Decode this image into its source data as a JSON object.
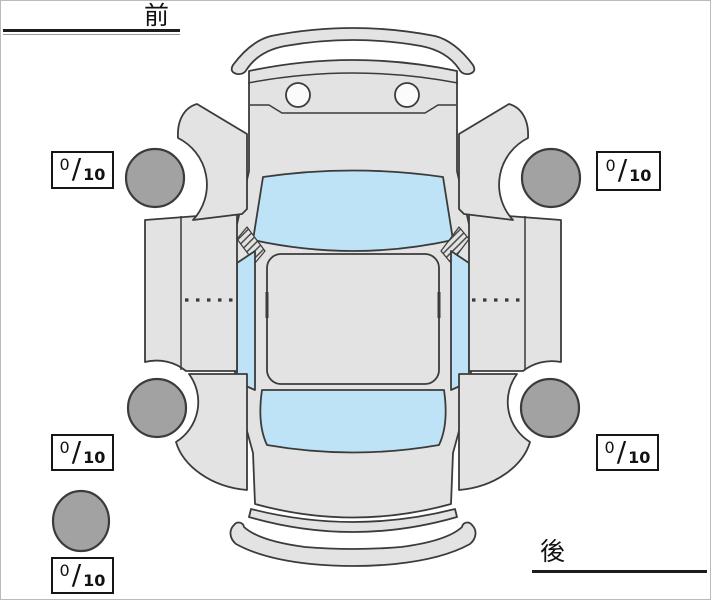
{
  "labels": {
    "front": "前",
    "rear": "後"
  },
  "scores": {
    "separator": "/",
    "items": [
      {
        "id": "front-left",
        "value": "0",
        "max": "10"
      },
      {
        "id": "front-right",
        "value": "0",
        "max": "10"
      },
      {
        "id": "rear-left",
        "value": "0",
        "max": "10"
      },
      {
        "id": "rear-right",
        "value": "0",
        "max": "10"
      },
      {
        "id": "spare",
        "value": "0",
        "max": "10"
      }
    ]
  },
  "diagram": {
    "type": "vehicle-condition-top-view",
    "colors": {
      "body_panel": "#e3e3e3",
      "glass": "#bfe3f6",
      "wheel": "#a2a2a2",
      "outline": "#3b3b3b",
      "headlight": "#fbfbfb"
    }
  }
}
